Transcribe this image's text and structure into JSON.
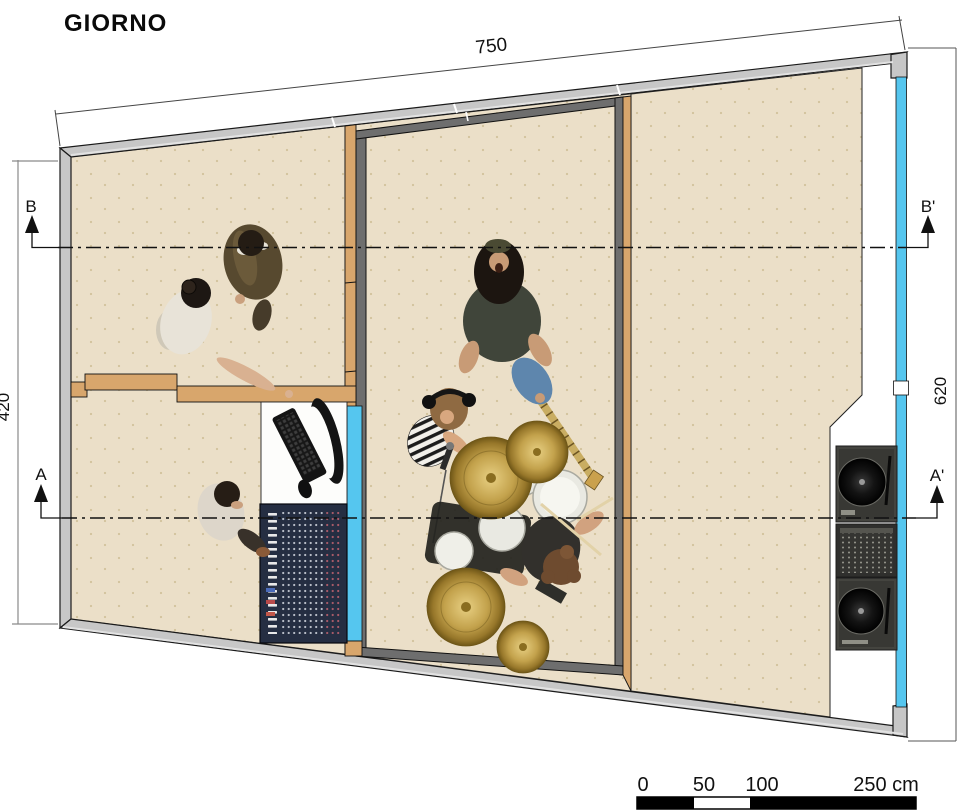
{
  "title": "GIORNO",
  "dimensions": {
    "top_width_cm": "750",
    "left_height_cm": "420",
    "right_height_cm": "620"
  },
  "section_markers": {
    "b": "B",
    "b_prime": "B'",
    "a": "A",
    "a_prime": "A'"
  },
  "scale_bar": {
    "labels": [
      "0",
      "50",
      "100",
      "250 cm"
    ]
  },
  "colors": {
    "floor": "#ebdfc8",
    "floor_dot": "#d2c29c",
    "outer_wall": "#c7c7c7",
    "inner_wall_dark": "#6e6e6e",
    "wood_wall": "#d8a66c",
    "glass": "#55c6ef",
    "cymbal_gold": "#c3a24c",
    "console": "#252e42"
  },
  "figures": [
    {
      "id": "people-talking",
      "label": "two people talking, top view"
    },
    {
      "id": "person-at-desk",
      "label": "engineer at desk, top view"
    },
    {
      "id": "guitarist",
      "label": "guitarist, top view"
    },
    {
      "id": "singer",
      "label": "singer with headphones and microphone, top view"
    },
    {
      "id": "drummer-and-kit",
      "label": "drummer with drum kit, top view"
    },
    {
      "id": "computer-workstation",
      "label": "monitor, keyboard and mouse"
    },
    {
      "id": "mixing-console",
      "label": "studio mixing console"
    },
    {
      "id": "dj-setup",
      "label": "two turntables and a DJ mixer"
    }
  ]
}
